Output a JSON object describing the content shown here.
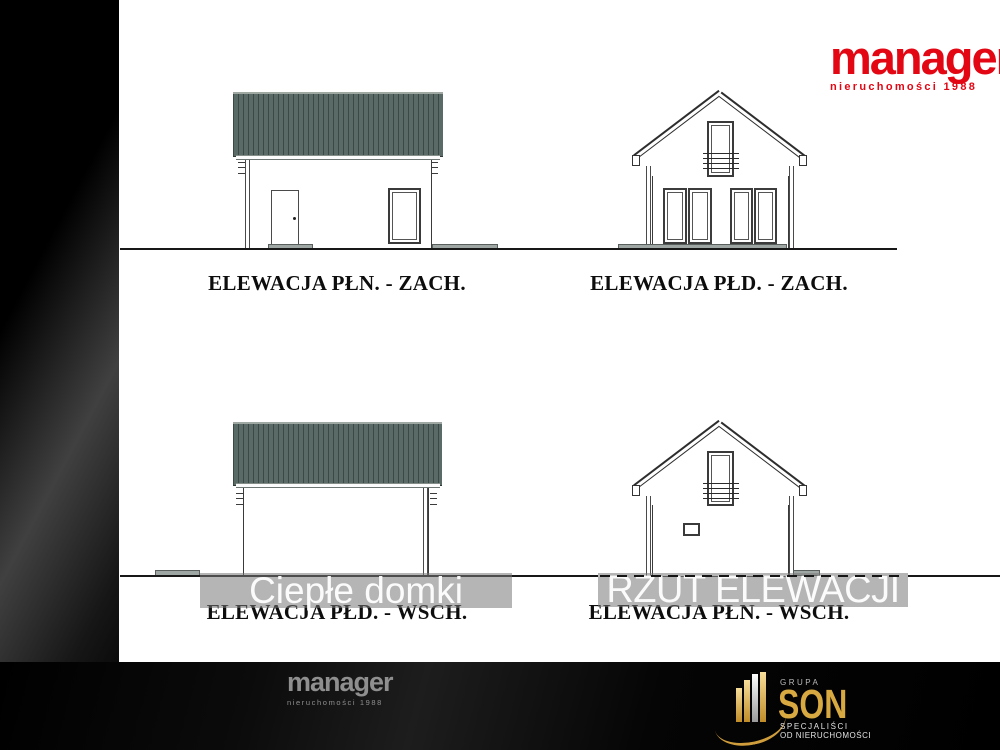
{
  "top_logo": {
    "name": "manager",
    "tagline": "nieruchomości 1988"
  },
  "elevations": [
    {
      "id": "nw",
      "label": "ELEWACJA PŁN. - ZACH."
    },
    {
      "id": "sw",
      "label": "ELEWACJA PŁD. - ZACH."
    },
    {
      "id": "se",
      "label": "ELEWACJA PŁD. - WSCH."
    },
    {
      "id": "ne",
      "label": "ELEWACJA PŁN. - WSCH."
    }
  ],
  "watermarks": {
    "left": "Ciepłe domki",
    "right": "RZUT ELEWACJI"
  },
  "footer": {
    "logo_name": "manager",
    "logo_tagline": "nieruchomości 1988",
    "group": {
      "top": "GRUPA",
      "name": "SON",
      "line1": "SPECJALIŚCI",
      "line2": "OD NIERUCHOMOŚCI"
    }
  },
  "colors": {
    "brand_red": "#e30613",
    "gold": "#d9a941",
    "roof_fill": "#5a6a67",
    "roof_stripe": "#3c4846",
    "watermark_box": "rgba(120,120,120,0.55)"
  }
}
